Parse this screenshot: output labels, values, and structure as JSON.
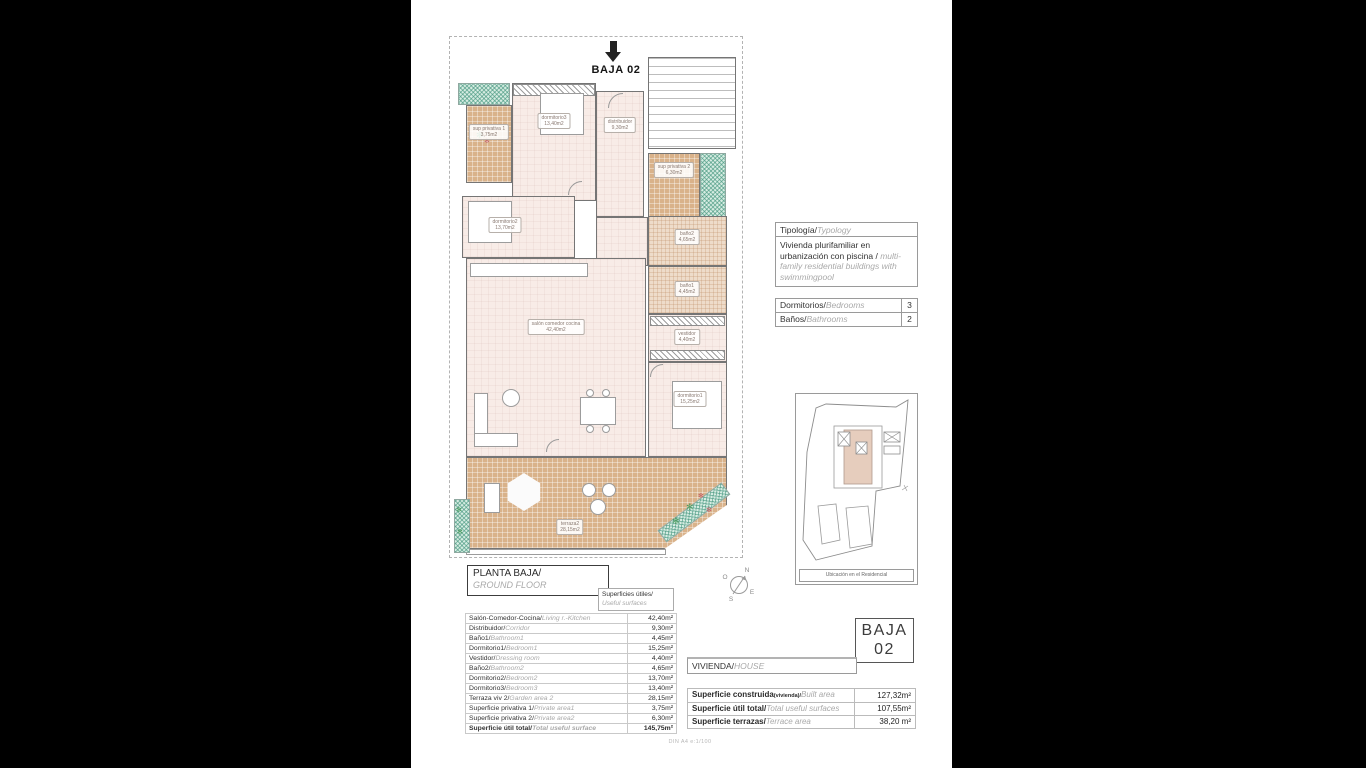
{
  "icons": {
    "plant": "✻"
  },
  "scale_note": "DIN A4  e:1/100",
  "plan": {
    "title": "BAJA 02",
    "rooms": [
      {
        "name": "sup privativa 1",
        "area": "3,75m2"
      },
      {
        "name": "dormitorio3",
        "area": "13,40m2"
      },
      {
        "name": "distribuidor",
        "area": "9,30m2"
      },
      {
        "name": "sup privativa 2",
        "area": "6,30m2"
      },
      {
        "name": "dormitorio2",
        "area": "13,70m2"
      },
      {
        "name": "baño2",
        "area": "4,65m2"
      },
      {
        "name": "baño1",
        "area": "4,45m2"
      },
      {
        "name": "salón comedor cocina",
        "area": "42,40m2"
      },
      {
        "name": "vestidor",
        "area": "4,40m2"
      },
      {
        "name": "dormitorio1",
        "area": "15,25m2"
      },
      {
        "name": "terraza2",
        "area": "28,15m2"
      }
    ]
  },
  "typology": {
    "title_es": "Tipología/",
    "title_en": "Typology",
    "body_es": "Vivienda plurifamiliar en urbanización con piscina  /",
    "body_en": "multi-family residential buildings with swimmingpool"
  },
  "counts": {
    "rows": [
      {
        "es": "Dormitorios/",
        "en": "Bedrooms",
        "value": "3"
      },
      {
        "es": "Baños/",
        "en": "Bathrooms",
        "value": "2"
      }
    ]
  },
  "location": {
    "caption": "Ubicación en el Residencial"
  },
  "compass": {
    "n": "N",
    "e": "E",
    "s": "S",
    "o": "O"
  },
  "floor_title": {
    "es": "PLANTA BAJA/",
    "en": "GROUND FLOOR"
  },
  "surfaces_header": {
    "es": "Superficies útiles/",
    "en": "Useful surfaces"
  },
  "useful": {
    "rows": [
      {
        "es": "Salón-Comedor-Cocina/",
        "en": "Living r.-Kitchen",
        "value": "42,40m²"
      },
      {
        "es": "Distribuidor/",
        "en": "Corridor",
        "value": "9,30m²"
      },
      {
        "es": "Baño1/",
        "en": "Bathroom1",
        "value": "4,45m²"
      },
      {
        "es": "Dormitorio1/",
        "en": "Bedroom1",
        "value": "15,25m²"
      },
      {
        "es": "Vestidor/",
        "en": "Dressing room",
        "value": "4,40m²"
      },
      {
        "es": "Baño2/",
        "en": "Bathroom2",
        "value": "4,65m²"
      },
      {
        "es": "Dormitorio2/",
        "en": "Bedroom2",
        "value": "13,70m²"
      },
      {
        "es": "Dormitorio3/",
        "en": "Bedroom3",
        "value": "13,40m²"
      },
      {
        "es": "Terraza viv 2/",
        "en": "Garden area 2",
        "value": "28,15m²"
      },
      {
        "es": "Superficie privativa 1/",
        "en": "Private area1",
        "value": "3,75m²"
      },
      {
        "es": "Superficie privativa 2/",
        "en": "Private area2",
        "value": "6,30m²"
      },
      {
        "es": "Superficie útil total/",
        "en": "Total useful surface",
        "value": "145,75m²"
      }
    ]
  },
  "badge": {
    "line1": "BAJA",
    "line2": "02"
  },
  "vivienda": {
    "es": "VIVIENDA/",
    "en": "HOUSE"
  },
  "summary": {
    "rows": [
      {
        "es": "Superficie construida",
        "sub": "(vivienda)/",
        "en": "Built area",
        "value": "127,32m²"
      },
      {
        "es": "Superficie útil total/",
        "en": "Total useful surfaces",
        "value": "107,55m²"
      },
      {
        "es": "Superficie terrazas/",
        "en": "Terrace area",
        "value": "38,20 m²"
      }
    ]
  }
}
